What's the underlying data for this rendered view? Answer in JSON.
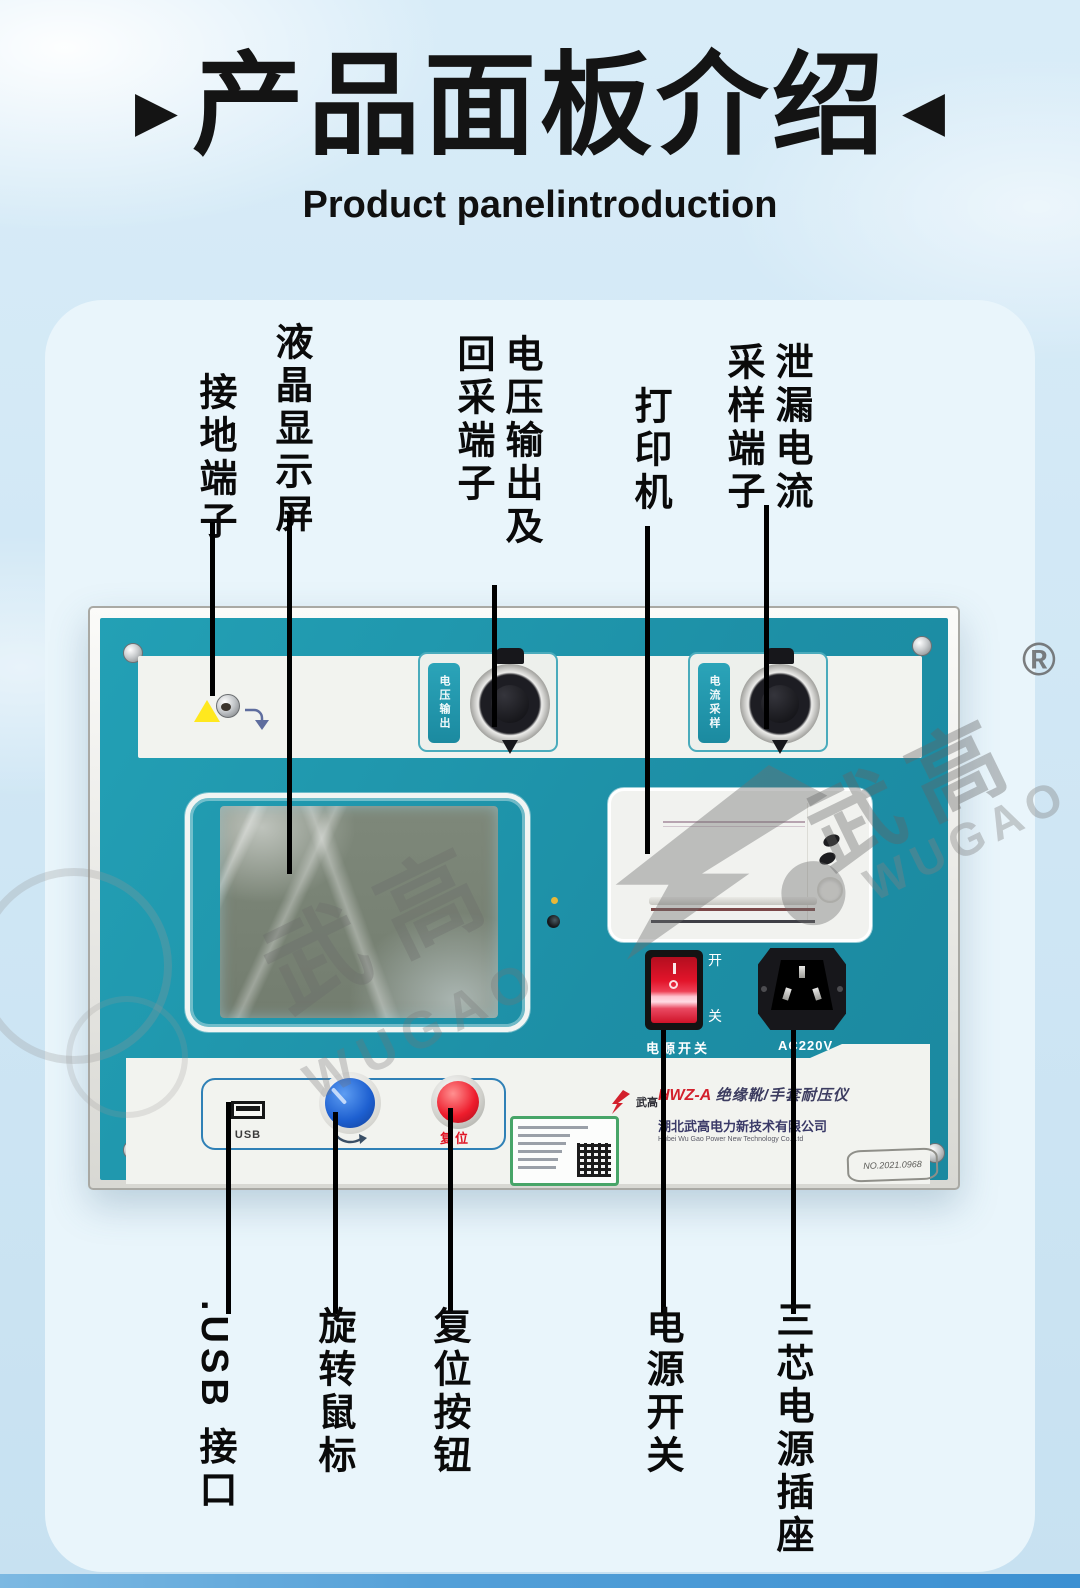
{
  "header": {
    "title": "产品面板介绍",
    "subtitle": "Product panelintroduction",
    "arrow_left": "▶",
    "arrow_right": "◀"
  },
  "callouts": {
    "top": [
      {
        "label": "接地端子"
      },
      {
        "label": "液晶显示屏"
      },
      {
        "label_right": "电压输出及",
        "label_left": "回采端子"
      },
      {
        "label": "打印机"
      },
      {
        "label_right": "泄漏电流",
        "label_left": "采样端子"
      }
    ],
    "bottom": [
      {
        "label": ".USB 接口"
      },
      {
        "label": "旋转鼠标"
      },
      {
        "label": "复位按钮"
      },
      {
        "label": "电源开关"
      },
      {
        "label": "三芯电源插座"
      }
    ]
  },
  "device": {
    "connector_voltage_label": "电压输出",
    "connector_current_label": "电流采样",
    "usb_label": "USB",
    "reset_label": "复位",
    "switch_on": "开",
    "switch_off": "关",
    "switch_label": "电源开关",
    "socket_label": "AC220V",
    "model_prefix": "HWZ-A",
    "model_name": "绝缘靴/手套耐压仪",
    "brand_mark": "武高",
    "company_cn": "湖北武高电力新技术有限公司",
    "company_en": "Hubei Wu Gao Power New Technology Co.,Ltd",
    "serial_no": "NO.2021.0968"
  },
  "watermark": {
    "cn": "武高",
    "en": "WUGAO",
    "registered": "®"
  },
  "colors": {
    "teal": "#1f95ab",
    "accent_red": "#e01525",
    "sky": "#cde5f3",
    "bar_blue": "#3c90d2"
  }
}
